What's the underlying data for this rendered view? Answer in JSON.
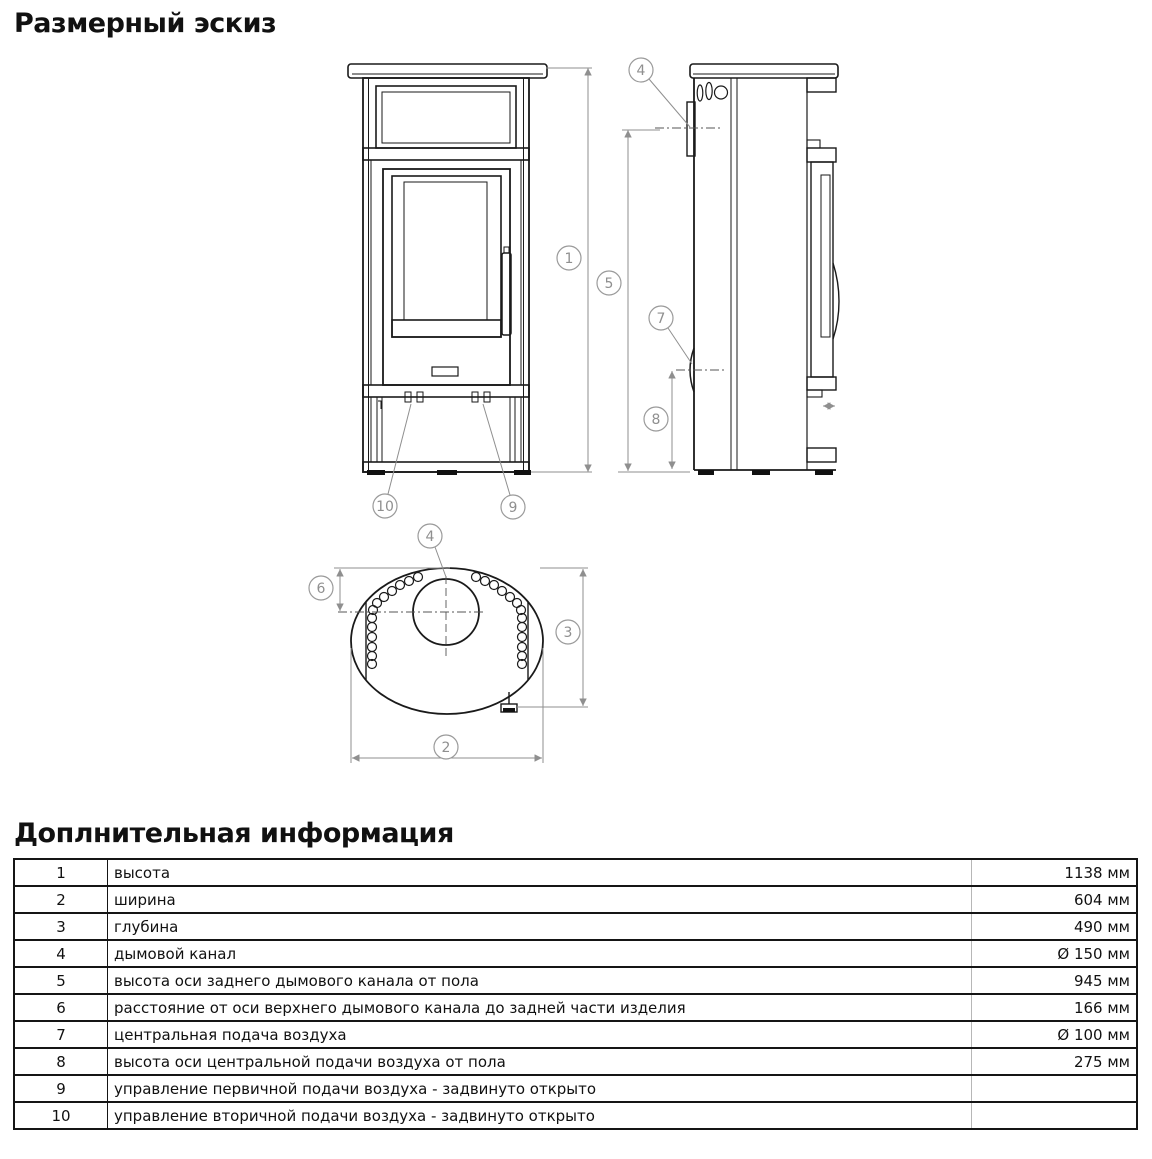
{
  "page": {
    "sketch_title": "Размерный эскиз",
    "info_title": "Доплнительная информация"
  },
  "callouts": {
    "c1": "1",
    "c2": "2",
    "c3": "3",
    "c4": "4",
    "c5": "5",
    "c6": "6",
    "c7": "7",
    "c8": "8",
    "c9": "9",
    "c10": "10"
  },
  "table": {
    "rows": [
      {
        "num": "1",
        "desc": "высота",
        "value": "1138 мм"
      },
      {
        "num": "2",
        "desc": "ширина",
        "value": "604 мм"
      },
      {
        "num": "3",
        "desc": "глубина",
        "value": "490 мм"
      },
      {
        "num": "4",
        "desc": "дымовой канал",
        "value": "Ø 150 мм"
      },
      {
        "num": "5",
        "desc": "высота оси заднего дымового канала от пола",
        "value": "945 мм"
      },
      {
        "num": "6",
        "desc": "расстояние от оси верхнего дымового канала до задней части изделия",
        "value": "166 мм"
      },
      {
        "num": "7",
        "desc": "центральная подача воздуха",
        "value": "Ø 100 мм"
      },
      {
        "num": "8",
        "desc": "высота оси центральной подачи воздуха от пола",
        "value": "275 мм"
      },
      {
        "num": "9",
        "desc": "управление первичной подачи воздуха - задвинуто открыто",
        "value": ""
      },
      {
        "num": "10",
        "desc": "управление вторичной подачи воздуха - задвинуто открыто",
        "value": ""
      }
    ]
  },
  "colors": {
    "object_line": "#1a1a1a",
    "dimension_line": "#8f8f8f"
  }
}
